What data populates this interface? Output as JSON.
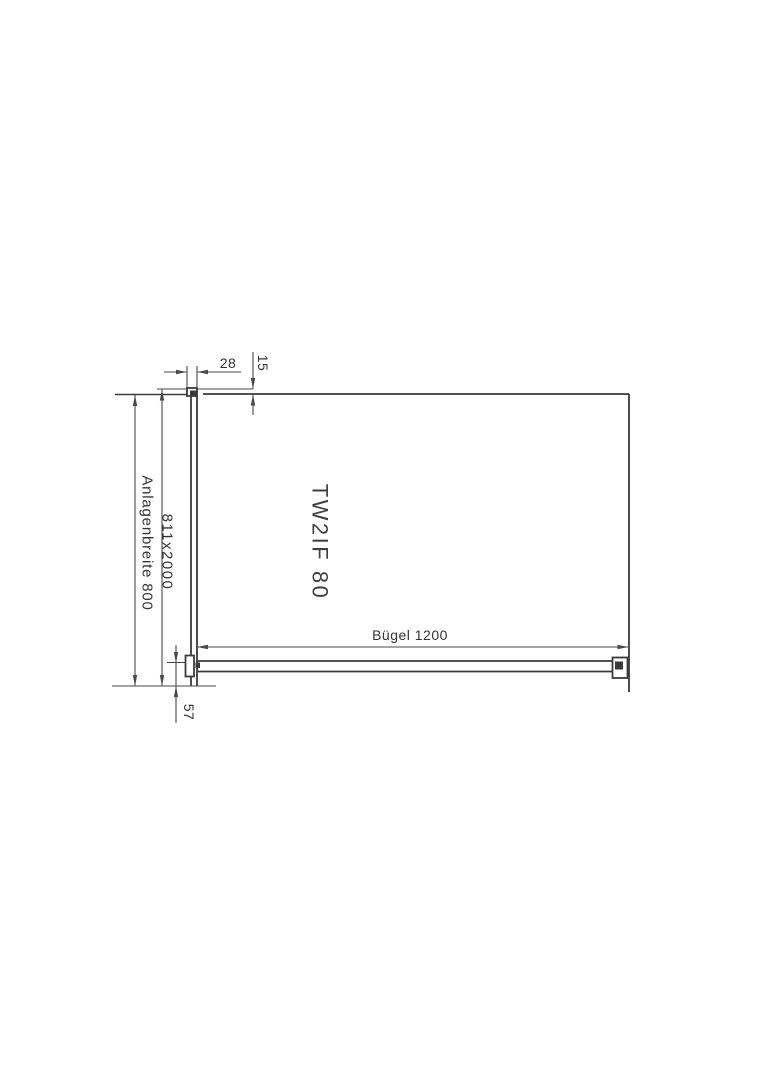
{
  "drawing": {
    "labels": {
      "profile_width": "28",
      "wall_gap": "15",
      "installation_width": "Anlagenbreite 800",
      "glass_size": "811x2000",
      "model": "TW2IF 80",
      "support_bar": "Bügel 1200",
      "bar_offset": "57"
    },
    "colors": {
      "line": "#3a3a3a",
      "dim": "#4a4a4a",
      "text": "#333333",
      "background": "#ffffff"
    }
  }
}
